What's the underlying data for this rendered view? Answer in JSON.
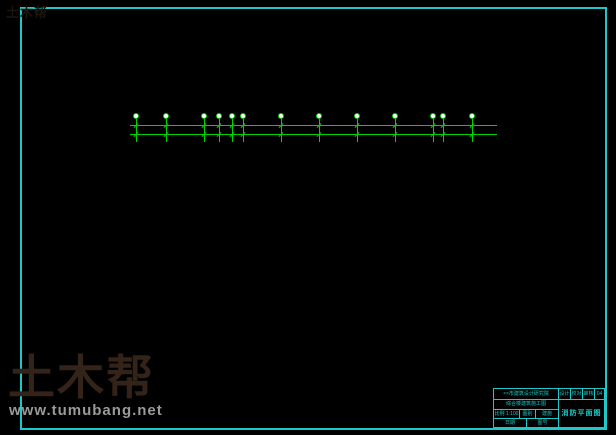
{
  "watermark": {
    "logo_text": "土木帮",
    "site_text": "www.tumubang.net"
  },
  "corner_watermark": "土木帮",
  "title_block": {
    "design_org": "××市建筑设计研究院",
    "project_name": "综合楼建筑施工图",
    "row3_cells": [
      "比例 1:100",
      "图别",
      "建施"
    ],
    "row4_cells": [
      "日期",
      "图号"
    ],
    "top_cells": [
      "设计",
      "校对",
      "审核",
      "04"
    ],
    "drawing_title": "消防平面图"
  },
  "colors": {
    "frame_cyan": "#1FC8C8",
    "grid_green": "#00D400",
    "grid_red": "#A80000",
    "grid_red_bright": "#E00000",
    "wall_white": "#E0E0E0",
    "wall_cyan": "#00E0E0",
    "window_navy": "#0000B8",
    "text_blue": "#2B2BFF",
    "stair_yellow": "#FFE000",
    "title_cyan": "#19C9C9",
    "watermark_brown": "#332318",
    "watermark_gray": "#9A9A9A"
  }
}
